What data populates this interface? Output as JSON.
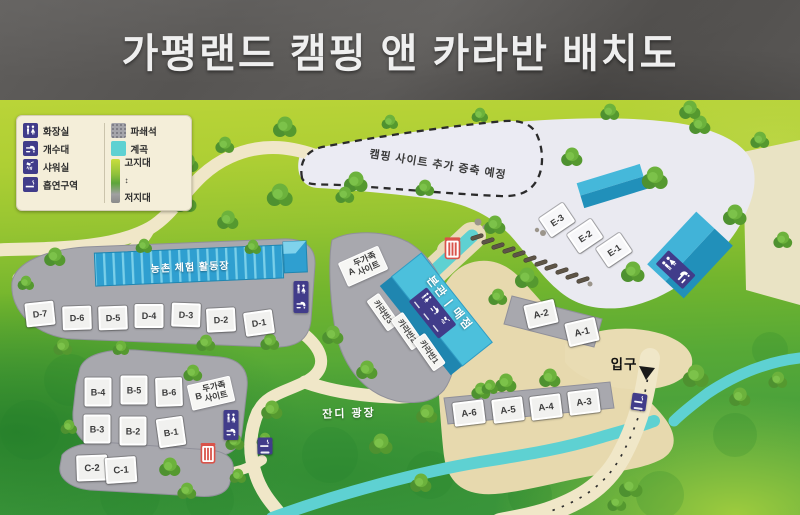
{
  "title": "가평랜드 캠핑 앤 카라반 배치도",
  "legend": {
    "toilet": "화장실",
    "sink": "개수대",
    "shower": "샤워실",
    "smoking": "흡연구역",
    "crushed_stone": "파쇄석",
    "valley": "계곡",
    "highland": "고지대",
    "lowland": "저지대",
    "elevation_arrow": "↕"
  },
  "labels": {
    "expansion": "캠핑 사이트 추가 증축 예정",
    "activity_center": "농촌 체험 활동장",
    "main_store": "본관 | 매점",
    "grass_plaza": "잔디 광장",
    "entrance": "입구",
    "two_family": "두가족",
    "site_word": "사이트",
    "prefix_a": "A",
    "prefix_b": "B"
  },
  "caravans": [
    "카라반3",
    "카라반2",
    "카라반1"
  ],
  "sites": {
    "d": [
      "D-7",
      "D-6",
      "D-5",
      "D-4",
      "D-3",
      "D-2",
      "D-1"
    ],
    "b": [
      "B-4",
      "B-5",
      "B-6",
      "B-3",
      "B-2",
      "B-1"
    ],
    "c": [
      "C-2",
      "C-1"
    ],
    "a_upper": [
      "A-2",
      "A-1"
    ],
    "a_lower": [
      "A-6",
      "A-5",
      "A-4",
      "A-3"
    ],
    "e": [
      "E-3",
      "E-2",
      "E-1"
    ]
  },
  "icons": {
    "toilet": "restroom-figures",
    "sink": "faucet",
    "shower": "shower-head",
    "smoking": "cigarette",
    "trash": "red-striped-bin",
    "entrance_arrow": "▼"
  },
  "colors": {
    "building_blue": "#2f9fd0",
    "sign_purple": "#413c8a",
    "stream_cyan": "#5ed1d2",
    "bin_red": "#d9534a",
    "road_beige": "#f0e7c8",
    "gravel_gray": "#a8a8ae"
  }
}
